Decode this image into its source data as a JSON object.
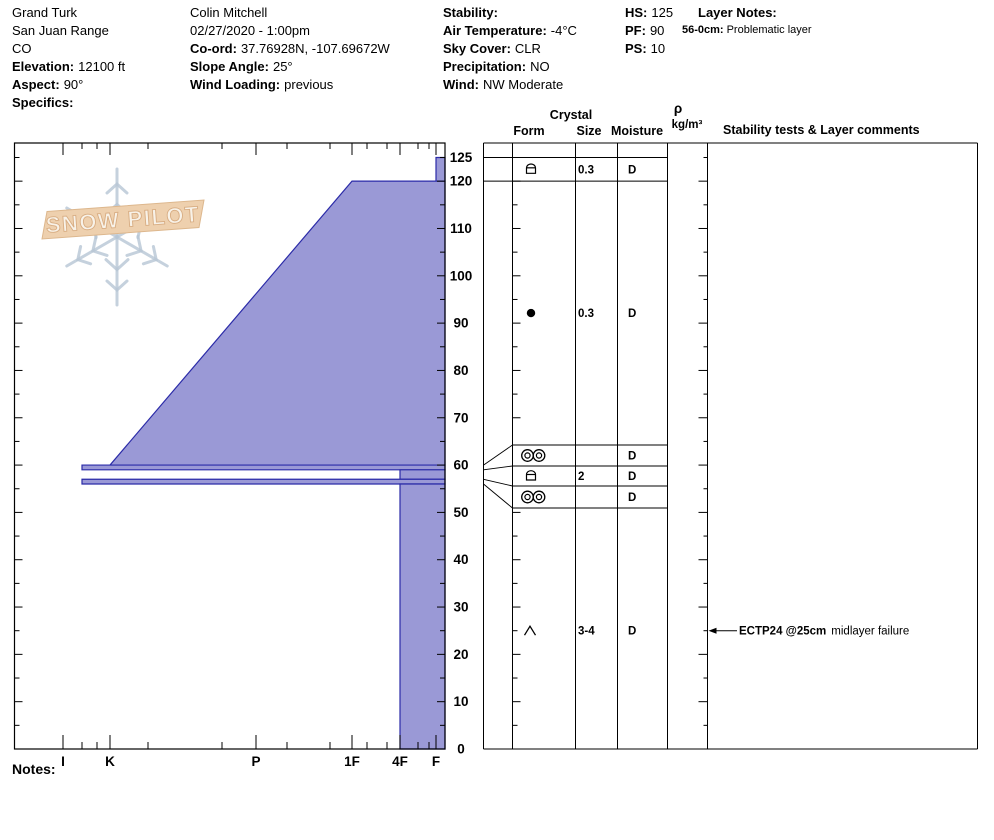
{
  "header": {
    "location": {
      "name": "Grand Turk",
      "range": "San Juan Range",
      "state": "CO",
      "elevation_label": "Elevation:",
      "elevation": "12100 ft",
      "aspect_label": "Aspect:",
      "aspect": "90°",
      "specifics_label": "Specifics:",
      "specifics": ""
    },
    "observer": {
      "name": "Colin Mitchell",
      "datetime": "02/27/2020 - 1:00pm",
      "coord_label": "Co-ord:",
      "coord": "37.76928N, -107.69672W",
      "slope_angle_label": "Slope Angle:",
      "slope_angle": "25°",
      "wind_loading_label": "Wind Loading:",
      "wind_loading": "previous"
    },
    "conditions": {
      "stability_label": "Stability:",
      "stability": "",
      "air_temp_label": "Air Temperature:",
      "air_temp": "-4°C",
      "sky_label": "Sky Cover:",
      "sky": "CLR",
      "precip_label": "Precipitation:",
      "precip": "NO",
      "wind_label": "Wind:",
      "wind": "NW Moderate"
    },
    "snowpack": {
      "hs_label": "HS:",
      "hs": "125",
      "pf_label": "PF:",
      "pf": "90",
      "ps_label": "PS:",
      "ps": "10"
    },
    "layer_notes": {
      "title": "Layer Notes:",
      "entries": [
        {
          "range": "56-0cm:",
          "text": "Problematic layer"
        }
      ]
    }
  },
  "footer": {
    "notes_label": "Notes:"
  },
  "logo": {
    "text": "SNOW PILOT"
  },
  "chart_data": {
    "type": "snow-profile",
    "title": "Snow pit hardness profile with grain form table",
    "depth_axis": {
      "unit": "cm",
      "max": 125,
      "label_values": [
        125,
        120,
        110,
        100,
        90,
        80,
        70,
        60,
        50,
        40,
        30,
        20,
        10,
        0
      ],
      "tick_step_minor": 5,
      "tick_step_major": 10
    },
    "hardness_axis": {
      "categories": [
        "I",
        "K",
        "P",
        "1F",
        "4F",
        "F"
      ]
    },
    "total_height_cm": 125,
    "layers": [
      {
        "top": 125,
        "bottom": 120,
        "hardness_top": "F",
        "hardness_bottom": "F"
      },
      {
        "top": 120,
        "bottom": 60,
        "hardness_top": "1F",
        "hardness_bottom": "K"
      },
      {
        "top": 60,
        "bottom": 59,
        "hardness_top": "K+",
        "hardness_bottom": "K+"
      },
      {
        "top": 59,
        "bottom": 57,
        "hardness_top": "4F",
        "hardness_bottom": "4F"
      },
      {
        "top": 57,
        "bottom": 56,
        "hardness_top": "K+",
        "hardness_bottom": "K+"
      },
      {
        "top": 56,
        "bottom": 0,
        "hardness_top": "4F",
        "hardness_bottom": "4F"
      }
    ],
    "grains": [
      {
        "top": 125,
        "bottom": 120,
        "form": "rounding-faceted",
        "size": "0.3",
        "moisture": "D"
      },
      {
        "top": 120,
        "bottom": 60,
        "form": "rounded-grains",
        "size": "0.3",
        "moisture": "D"
      },
      {
        "top": 60,
        "bottom": 59,
        "form": "melt-freeze-crust",
        "size": "",
        "moisture": "D"
      },
      {
        "top": 59,
        "bottom": 57,
        "form": "rounding-faceted",
        "size": "2",
        "moisture": "D"
      },
      {
        "top": 57,
        "bottom": 56,
        "form": "melt-freeze-crust",
        "size": "",
        "moisture": "D"
      },
      {
        "top": 56,
        "bottom": 0,
        "form": "depth-hoar",
        "size": "3-4",
        "moisture": "D"
      }
    ],
    "tests": [
      {
        "label": "ECTP24 @25cm",
        "comment": "midlayer failure",
        "depth": 25
      }
    ],
    "table_headers": {
      "crystal": "Crystal",
      "form": "Form",
      "size": "Size",
      "moisture": "Moisture",
      "rho": "ρ",
      "rho_units": "kg/m³",
      "comments": "Stability tests & Layer comments"
    },
    "colors": {
      "layer_fill": "#9a99d6",
      "layer_stroke": "#2b2ba8",
      "axis": "#000000",
      "logo_banner_fill": "#eed0ae",
      "logo_banner_stroke": "#ddb78d",
      "logo_flake": "#b7c6d5",
      "logo_text_fill": "#f8f2e8",
      "logo_text_stroke": "#d8ad83"
    }
  }
}
